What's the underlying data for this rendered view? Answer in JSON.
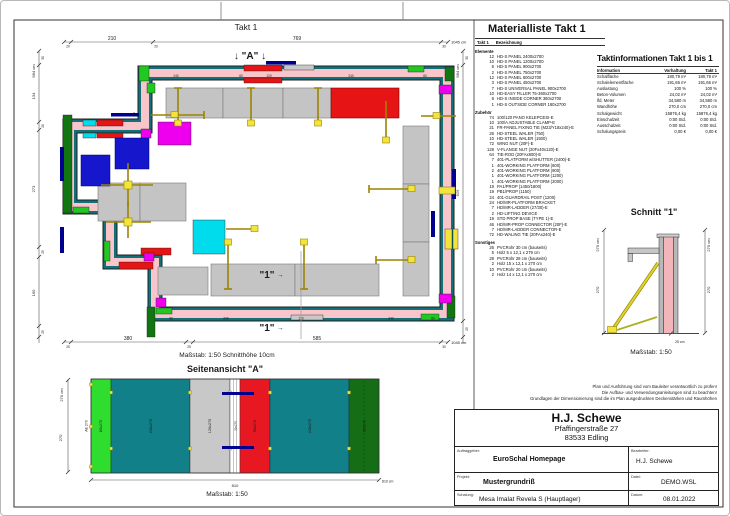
{
  "sheet": {
    "viewport_title": "Takt 1"
  },
  "plan": {
    "marker_a_full": "↓ \"A\" ↓",
    "marker_1": "\"1\"",
    "marker_arrow": "→",
    "label_14": "14",
    "scale_line": "Maßstab: 1:50   Schnitthöhe 10cm",
    "dim_top": {
      "seg1": "210",
      "seg2": "769",
      "t1": "20",
      "t2": "20",
      "t3": "30",
      "total": "1045 cm"
    },
    "dim_bottom": {
      "seg1": "380",
      "seg2": "585",
      "t1": "25",
      "t2": "25",
      "t3": "30",
      "total": "1045 cm"
    },
    "dim_left": {
      "total": "684 cm",
      "t1": "30",
      "seg1": "134",
      "t2": "20",
      "seg2": "273",
      "t3": "25",
      "seg3": "160",
      "t4": "25"
    },
    "dim_right": {
      "total": "684 cm",
      "t1": "30",
      "seg1": "629",
      "t2": "25"
    },
    "wall_labels_top": [
      "240",
      "60",
      "120",
      "240",
      "60"
    ],
    "wall_labels_bottom": [
      "60",
      "240",
      "120",
      "240",
      "60"
    ]
  },
  "material_list": {
    "title": "Materialliste  Takt 1",
    "header_takt": "Takt 1",
    "header_desc": "Bezeichnung",
    "groups": [
      {
        "name": "Elemente",
        "items": [
          {
            "qty": "12",
            "desc": "HD-S PANEL 2400x2700"
          },
          {
            "qty": "10",
            "desc": "HD-S PANEL 1200x2700"
          },
          {
            "qty": "6",
            "desc": "HD-S PANEL 900x2700"
          },
          {
            "qty": "2",
            "desc": "HD-S PANEL 750x2700"
          },
          {
            "qty": "12",
            "desc": "HD-S PANEL 600x2700"
          },
          {
            "qty": "3",
            "desc": "HD-S PANEL 450x2700"
          },
          {
            "qty": "7",
            "desc": "HD-S UNIVERSAL PANEL 900x2700"
          },
          {
            "qty": "10",
            "desc": "HD-EASY FILLER 75-360x2700"
          },
          {
            "qty": "8",
            "desc": "HD-S INSIDE CORNER 360x2700"
          },
          {
            "qty": "1",
            "desc": "HD-S OUTSIDE CORNER 180x2700"
          }
        ]
      },
      {
        "name": "Zubehör",
        "items": [
          {
            "qty": "74",
            "desc": "100/120 PANO KELEPCESI-E"
          },
          {
            "qty": "10",
            "desc": "100/A ADJUSTABLE CLAMP-E"
          },
          {
            "qty": "21",
            "desc": "FR-PANEL FIXING TIE (M23/Y18x240)-E"
          },
          {
            "qty": "26",
            "desc": "HD-STEEL WALER (750)"
          },
          {
            "qty": "10",
            "desc": "HD-STEEL WALER (1500)"
          },
          {
            "qty": "72",
            "desc": "WING NUT (20F)-E"
          },
          {
            "qty": "128",
            "desc": "V-FLANGE NUT (20Fx40x120)-E"
          },
          {
            "qty": "64",
            "desc": "TIE-ROD (20FAx800)-E"
          },
          {
            "qty": "7",
            "desc": "401-PLATFORM w/SHUTTER (2400)-E"
          },
          {
            "qty": "1",
            "desc": "401-WORKING PLATFORM (600)"
          },
          {
            "qty": "2",
            "desc": "401-WORKING PLATFORM (900)"
          },
          {
            "qty": "1",
            "desc": "401-WORKING PLATFORM (1200)"
          },
          {
            "qty": "1",
            "desc": "401-WORKING PLATFORM (2000)"
          },
          {
            "qty": "19",
            "desc": "PA1/PROP (1450/1800)"
          },
          {
            "qty": "19",
            "desc": "PB1/PROP (1150)"
          },
          {
            "qty": "24",
            "desc": "401-GUARDRAIL POST (1200)"
          },
          {
            "qty": "24",
            "desc": "HD/MR-PLATFORM BRACKET"
          },
          {
            "qty": "7",
            "desc": "HD/MR-LADDER (27/30)-E"
          },
          {
            "qty": "2",
            "desc": "HD-LIFTING DEVICE"
          },
          {
            "qty": "19",
            "desc": "STD PROP BASE (TYPE 1)-E"
          },
          {
            "qty": "46",
            "desc": "HD/MR-PROP CONNECTOR (20F)-E"
          },
          {
            "qty": "7",
            "desc": "HD/MR-LADDER CONNECTOR-E"
          },
          {
            "qty": "72",
            "desc": "HD-WALING TIE (20FAx240)-E"
          }
        ]
      },
      {
        "name": "Sonstiges",
        "items": [
          {
            "qty": "26",
            "desc": "PVCRohr 30 cm (bauseits)"
          },
          {
            "qty": "5",
            "desc": "Holz 5 x 12,1 x 279 cm"
          },
          {
            "qty": "28",
            "desc": "PVCRohr 28 cm (bauseits)"
          },
          {
            "qty": "2",
            "desc": "Holz 15 x 12,1 x 270 cm"
          },
          {
            "qty": "10",
            "desc": "PVCRohr 20 cm (bauseits)"
          },
          {
            "qty": "2",
            "desc": "Holz 14 x 12,1 x 270 cm"
          }
        ]
      }
    ]
  },
  "takt_info": {
    "title": "Taktinformationen  Takt 1 bis 1",
    "col1": "Information",
    "col2": "Vorhaltung",
    "col3": "Takt 1",
    "rows": [
      {
        "label": "Schalfläche",
        "vorhaltung": "180,79 m²",
        "takt": "180,79 m²"
      },
      {
        "label": "Schalelementfläche",
        "vorhaltung": "191,66 m²",
        "takt": "191,66 m²"
      },
      {
        "label": "Auslastung",
        "vorhaltung": "100 %",
        "takt": "100 %"
      },
      {
        "label": "Beton-Volumen",
        "vorhaltung": "24,02 m³",
        "takt": "24,02 m³"
      },
      {
        "label": "lfd. Meter",
        "vorhaltung": "34,580 m",
        "takt": "34,580 m"
      },
      {
        "label": "Wandhöhe",
        "vorhaltung": "270,0 cm",
        "takt": "270,0 cm"
      },
      {
        "label": "Schalgewicht",
        "vorhaltung": "15876,4 kg",
        "takt": "15876,4 kg"
      },
      {
        "label": "Einschalzeit",
        "vorhaltung": "0:00 Std.",
        "takt": "0:00 Std."
      },
      {
        "label": "Ausschalzeit",
        "vorhaltung": "0:00 Std.",
        "takt": "0:00 Std."
      },
      {
        "label": "Schalungspreis",
        "vorhaltung": "0,00 €",
        "takt": "0,00 €"
      }
    ]
  },
  "schnitt": {
    "title": "Schnitt \"1\"",
    "dim_left_total": "270 cm",
    "dim_left": "270",
    "dim_right_total": "270 cm",
    "dim_right": "270",
    "dim_bottom": "25 cm",
    "scale": "Maßstab: 1:50"
  },
  "elevation": {
    "title": "Seitenansicht \"A\"",
    "scale": "Maßstab: 1:50",
    "dim_left_total": "270 cm",
    "dim_left": "270",
    "dim_bottom": "810",
    "dim_bottom_total": "810 cm",
    "edge_label": "AE 270",
    "segments": [
      {
        "label": "60x270",
        "color": "#2fdd2f"
      },
      {
        "label": "240x270",
        "color": "#128089"
      },
      {
        "label": "120x270",
        "color": "#c8c8c8"
      },
      {
        "label": "30x270",
        "color": "#ffffff"
      },
      {
        "label": "90x270",
        "color": "#e81822"
      },
      {
        "label": "240x270",
        "color": "#128089"
      },
      {
        "label": "90x270",
        "color": "#156e15"
      }
    ]
  },
  "notice": {
    "lines": [
      "Plan und Ausführung sind vom Bauleiter verantwortlich zu prüfen!",
      "Die Aufbau- und Verwendungsanleitungen sind zu beachten!",
      "Grundlagen der Dimensionierung sind die im Plan ausgedruckten Deckenstärken und Raumhöhen"
    ]
  },
  "title_block": {
    "company": "H.J. Schewe",
    "address1": "Pfaffingerstraße 27",
    "address2": "83533 Edling",
    "auftraggeber_label": "Auftraggeber:",
    "auftraggeber": "EuroSchal Homepage",
    "bearbeiter_label": "Bearbeiter:",
    "bearbeiter": "H.J. Schewe",
    "projekt_label": "Projekt:",
    "projekt": "Mustergrundriß",
    "datei_label": "Datei:",
    "datei": "DEMO.WSL",
    "schalung_label": "Schalung:",
    "schalung": "Mesa Imalat Revela S (Hauptlager)",
    "datum_label": "Datum:",
    "datum": "08.01.2022"
  },
  "palette": {
    "wall_pink": "#f8c6ca",
    "form_teal": "#117078",
    "panel_green": "#22c822",
    "panel_dark_green": "#117611",
    "panel_red": "#e61414",
    "panel_magenta": "#ee00ee",
    "panel_cyan": "#00dcec",
    "panel_blue": "#1616cc",
    "tie_navy": "#000090",
    "platform_gray": "#c4c4c4",
    "prop_yellow": "#f2e43a"
  }
}
